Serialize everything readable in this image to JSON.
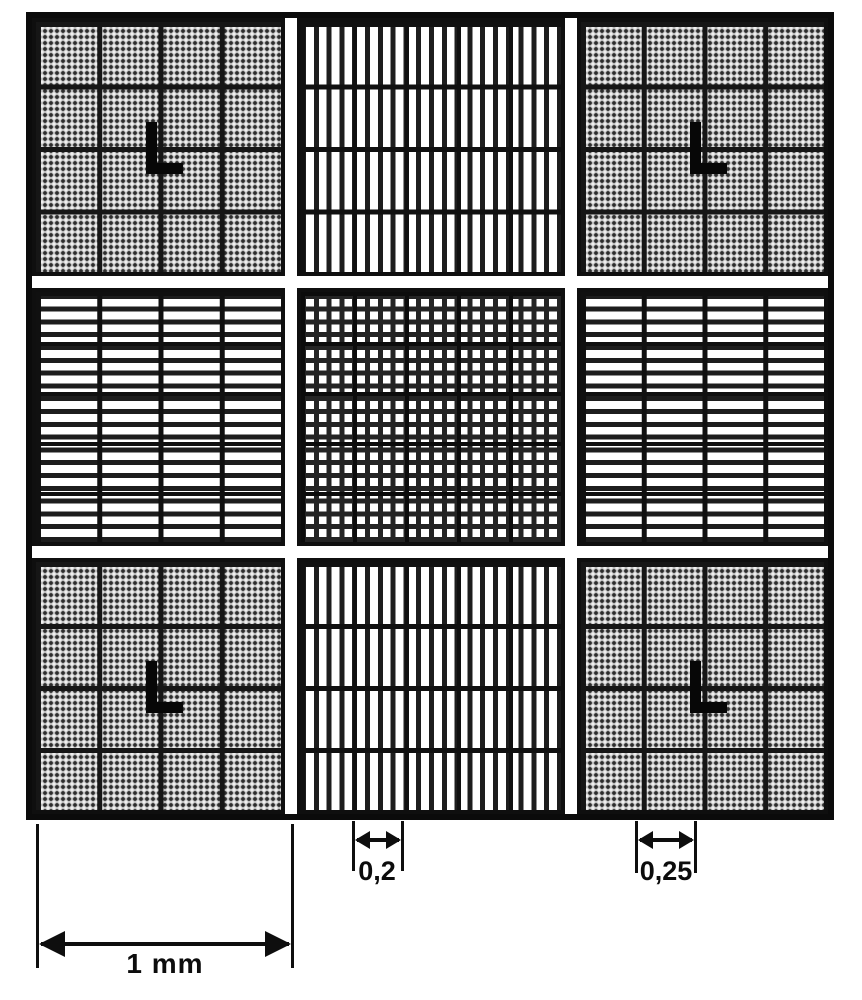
{
  "figure": {
    "type": "hemocytometer-counting-chamber-grid",
    "labels": {
      "big_square_width": "1 mm",
      "group_width": "0,2",
      "corner_cell_width": "0,25"
    },
    "grid": {
      "rows": 3,
      "columns": 3,
      "corner_square_cells": "4x4",
      "corner_mark_shape": "L"
    },
    "colors": {
      "ink": "#0e0e0e",
      "halftone_gray": "#bcbcbc",
      "paper": "#ffffff"
    }
  }
}
